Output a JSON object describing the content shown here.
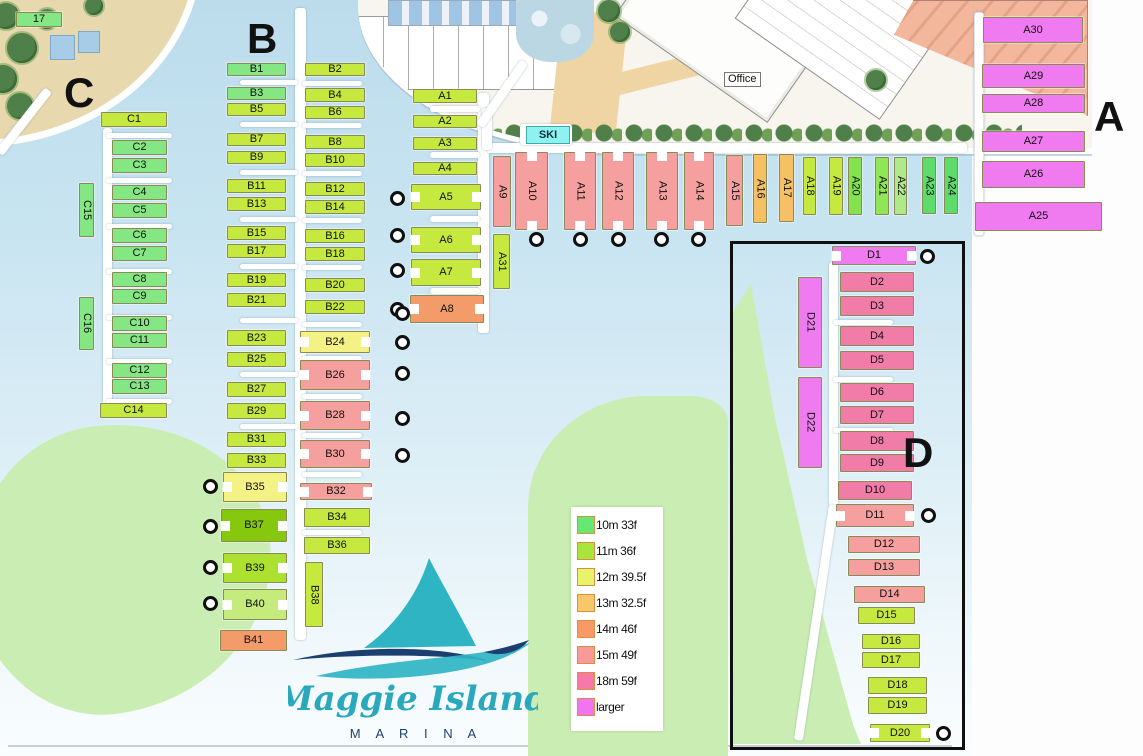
{
  "branding": {
    "script": "Maggie Island",
    "sub": "M A R I N A"
  },
  "labels": {
    "office": "Office",
    "ski": "SKI"
  },
  "legend": {
    "items": [
      {
        "label": "10m 33f",
        "color": "#66E873"
      },
      {
        "label": "11m 36f",
        "color": "#A9E63C"
      },
      {
        "label": "12m 39.5f",
        "color": "#E9F26B"
      },
      {
        "label": "13m 32.5f",
        "color": "#F8C76A"
      },
      {
        "label": "14m 46f",
        "color": "#F79A67"
      },
      {
        "label": "15m 49f",
        "color": "#F79A98"
      },
      {
        "label": "18m 59f",
        "color": "#F779A7"
      },
      {
        "label": "larger",
        "color": "#F175F0"
      }
    ]
  },
  "colors": {
    "g10": "#84E783",
    "g10b": "#5DDC6C",
    "y11": "#C6E93F",
    "y12": "#F5F285",
    "o13": "#F6C065",
    "o14": "#F49B6A",
    "p15": "#F5A09E",
    "p18": "#F27CA8",
    "mag": "#F07AEF",
    "b37": "#85C80D",
    "b39": "#ACE22F",
    "b40": "#C6EB7D",
    "a20": "#84E24F",
    "a21": "#8FE657",
    "a22": "#AEE98C"
  },
  "sections": [
    {
      "id": "A",
      "label": "A",
      "x": 1094,
      "y": 96
    },
    {
      "id": "B",
      "label": "B",
      "x": 247,
      "y": 18
    },
    {
      "id": "C",
      "label": "C",
      "x": 64,
      "y": 72
    },
    {
      "id": "D",
      "label": "D",
      "x": 903,
      "y": 432
    }
  ],
  "berths": [
    {
      "id": "17",
      "x": 16,
      "y": 12,
      "w": 46,
      "h": 15,
      "c": "g10"
    },
    {
      "id": "C1",
      "x": 101,
      "y": 112,
      "w": 66,
      "h": 15,
      "c": "y11"
    },
    {
      "id": "C2",
      "x": 112,
      "y": 140,
      "w": 55,
      "h": 15,
      "c": "g10"
    },
    {
      "id": "C3",
      "x": 112,
      "y": 158,
      "w": 55,
      "h": 15,
      "c": "g10"
    },
    {
      "id": "C4",
      "x": 112,
      "y": 185,
      "w": 55,
      "h": 15,
      "c": "g10"
    },
    {
      "id": "C5",
      "x": 112,
      "y": 203,
      "w": 55,
      "h": 15,
      "c": "g10"
    },
    {
      "id": "C6",
      "x": 112,
      "y": 228,
      "w": 55,
      "h": 15,
      "c": "g10"
    },
    {
      "id": "C7",
      "x": 112,
      "y": 246,
      "w": 55,
      "h": 15,
      "c": "g10"
    },
    {
      "id": "C8",
      "x": 112,
      "y": 272,
      "w": 55,
      "h": 15,
      "c": "g10"
    },
    {
      "id": "C9",
      "x": 112,
      "y": 289,
      "w": 55,
      "h": 15,
      "c": "g10"
    },
    {
      "id": "C10",
      "x": 112,
      "y": 316,
      "w": 55,
      "h": 15,
      "c": "g10"
    },
    {
      "id": "C11",
      "x": 112,
      "y": 333,
      "w": 55,
      "h": 15,
      "c": "g10"
    },
    {
      "id": "C12",
      "x": 112,
      "y": 363,
      "w": 55,
      "h": 15,
      "c": "g10"
    },
    {
      "id": "C13",
      "x": 112,
      "y": 379,
      "w": 55,
      "h": 15,
      "c": "g10"
    },
    {
      "id": "C14",
      "x": 100,
      "y": 403,
      "w": 67,
      "h": 15,
      "c": "y11"
    },
    {
      "id": "C15",
      "x": 79,
      "y": 183,
      "w": 15,
      "h": 54,
      "c": "g10",
      "v": 1
    },
    {
      "id": "C16",
      "x": 79,
      "y": 297,
      "w": 15,
      "h": 53,
      "c": "g10",
      "v": 1
    },
    {
      "id": "B1",
      "x": 227,
      "y": 63,
      "w": 59,
      "h": 13,
      "c": "g10"
    },
    {
      "id": "B3",
      "x": 227,
      "y": 87,
      "w": 59,
      "h": 13,
      "c": "g10"
    },
    {
      "id": "B5",
      "x": 227,
      "y": 103,
      "w": 59,
      "h": 13,
      "c": "y11"
    },
    {
      "id": "B7",
      "x": 227,
      "y": 133,
      "w": 59,
      "h": 13,
      "c": "y11"
    },
    {
      "id": "B9",
      "x": 227,
      "y": 151,
      "w": 59,
      "h": 13,
      "c": "y11"
    },
    {
      "id": "B11",
      "x": 227,
      "y": 179,
      "w": 59,
      "h": 14,
      "c": "y11"
    },
    {
      "id": "B13",
      "x": 227,
      "y": 197,
      "w": 59,
      "h": 14,
      "c": "y11"
    },
    {
      "id": "B15",
      "x": 227,
      "y": 226,
      "w": 59,
      "h": 14,
      "c": "y11"
    },
    {
      "id": "B17",
      "x": 227,
      "y": 244,
      "w": 59,
      "h": 14,
      "c": "y11"
    },
    {
      "id": "B19",
      "x": 227,
      "y": 273,
      "w": 59,
      "h": 14,
      "c": "y11"
    },
    {
      "id": "B21",
      "x": 227,
      "y": 293,
      "w": 59,
      "h": 14,
      "c": "y11"
    },
    {
      "id": "B23",
      "x": 227,
      "y": 330,
      "w": 59,
      "h": 16,
      "c": "y11"
    },
    {
      "id": "B25",
      "x": 227,
      "y": 352,
      "w": 59,
      "h": 15,
      "c": "y11"
    },
    {
      "id": "B27",
      "x": 227,
      "y": 382,
      "w": 59,
      "h": 15,
      "c": "y11"
    },
    {
      "id": "B29",
      "x": 227,
      "y": 403,
      "w": 59,
      "h": 16,
      "c": "y11"
    },
    {
      "id": "B31",
      "x": 227,
      "y": 432,
      "w": 59,
      "h": 15,
      "c": "y11"
    },
    {
      "id": "B33",
      "x": 227,
      "y": 453,
      "w": 59,
      "h": 15,
      "c": "y11"
    },
    {
      "id": "B35",
      "x": 223,
      "y": 472,
      "w": 64,
      "h": 30,
      "c": "y12",
      "n": 1
    },
    {
      "id": "B37",
      "x": 221,
      "y": 509,
      "w": 66,
      "h": 33,
      "c": "b37",
      "n": 1
    },
    {
      "id": "B39",
      "x": 223,
      "y": 553,
      "w": 64,
      "h": 30,
      "c": "b39",
      "n": 1
    },
    {
      "id": "B40",
      "x": 223,
      "y": 589,
      "w": 64,
      "h": 31,
      "c": "b40",
      "n": 1
    },
    {
      "id": "B41",
      "x": 220,
      "y": 630,
      "w": 67,
      "h": 21,
      "c": "o14"
    },
    {
      "id": "B2",
      "x": 305,
      "y": 63,
      "w": 60,
      "h": 13,
      "c": "y11"
    },
    {
      "id": "B4",
      "x": 305,
      "y": 88,
      "w": 60,
      "h": 14,
      "c": "y11"
    },
    {
      "id": "B6",
      "x": 305,
      "y": 106,
      "w": 60,
      "h": 13,
      "c": "y11"
    },
    {
      "id": "B8",
      "x": 305,
      "y": 135,
      "w": 60,
      "h": 14,
      "c": "y11"
    },
    {
      "id": "B10",
      "x": 305,
      "y": 153,
      "w": 60,
      "h": 14,
      "c": "y11"
    },
    {
      "id": "B12",
      "x": 305,
      "y": 182,
      "w": 60,
      "h": 14,
      "c": "y11"
    },
    {
      "id": "B14",
      "x": 305,
      "y": 200,
      "w": 60,
      "h": 14,
      "c": "y11"
    },
    {
      "id": "B16",
      "x": 305,
      "y": 229,
      "w": 60,
      "h": 14,
      "c": "y11"
    },
    {
      "id": "B18",
      "x": 305,
      "y": 247,
      "w": 60,
      "h": 14,
      "c": "y11"
    },
    {
      "id": "B20",
      "x": 305,
      "y": 278,
      "w": 60,
      "h": 14,
      "c": "y11"
    },
    {
      "id": "B22",
      "x": 305,
      "y": 300,
      "w": 60,
      "h": 14,
      "c": "y11"
    },
    {
      "id": "B24",
      "x": 300,
      "y": 331,
      "w": 70,
      "h": 22,
      "c": "y12",
      "n": 1
    },
    {
      "id": "B26",
      "x": 300,
      "y": 360,
      "w": 70,
      "h": 30,
      "c": "p15",
      "n": 1
    },
    {
      "id": "B28",
      "x": 300,
      "y": 401,
      "w": 70,
      "h": 29,
      "c": "p15",
      "n": 1
    },
    {
      "id": "B30",
      "x": 300,
      "y": 440,
      "w": 70,
      "h": 28,
      "c": "p15",
      "n": 1
    },
    {
      "id": "B32",
      "x": 300,
      "y": 483,
      "w": 72,
      "h": 17,
      "c": "p15",
      "n": 1
    },
    {
      "id": "B34",
      "x": 304,
      "y": 508,
      "w": 66,
      "h": 19,
      "c": "y11"
    },
    {
      "id": "B36",
      "x": 304,
      "y": 537,
      "w": 66,
      "h": 17,
      "c": "y11"
    },
    {
      "id": "B38",
      "x": 305,
      "y": 562,
      "w": 18,
      "h": 65,
      "c": "y11",
      "v": 1
    },
    {
      "id": "A1",
      "x": 413,
      "y": 89,
      "w": 64,
      "h": 14,
      "c": "y11"
    },
    {
      "id": "A2",
      "x": 413,
      "y": 115,
      "w": 64,
      "h": 13,
      "c": "y11"
    },
    {
      "id": "A3",
      "x": 413,
      "y": 137,
      "w": 64,
      "h": 13,
      "c": "y11"
    },
    {
      "id": "A4",
      "x": 413,
      "y": 162,
      "w": 64,
      "h": 13,
      "c": "y11"
    },
    {
      "id": "A5",
      "x": 411,
      "y": 184,
      "w": 70,
      "h": 26,
      "c": "y11",
      "n": 1
    },
    {
      "id": "A6",
      "x": 411,
      "y": 227,
      "w": 70,
      "h": 26,
      "c": "y11",
      "n": 1
    },
    {
      "id": "A7",
      "x": 411,
      "y": 259,
      "w": 70,
      "h": 27,
      "c": "y11",
      "n": 1
    },
    {
      "id": "A8",
      "x": 410,
      "y": 295,
      "w": 74,
      "h": 28,
      "c": "o14",
      "n": 1
    },
    {
      "id": "A31",
      "x": 493,
      "y": 234,
      "w": 17,
      "h": 55,
      "c": "y11",
      "v": 1
    },
    {
      "id": "A9",
      "x": 493,
      "y": 156,
      "w": 18,
      "h": 71,
      "c": "p15",
      "v": 1
    },
    {
      "id": "A10",
      "x": 515,
      "y": 152,
      "w": 33,
      "h": 78,
      "c": "p15",
      "v": 1,
      "n": 1
    },
    {
      "id": "A11",
      "x": 564,
      "y": 152,
      "w": 32,
      "h": 78,
      "c": "p15",
      "v": 1,
      "n": 1
    },
    {
      "id": "A12",
      "x": 602,
      "y": 152,
      "w": 32,
      "h": 78,
      "c": "p15",
      "v": 1,
      "n": 1
    },
    {
      "id": "A13",
      "x": 646,
      "y": 152,
      "w": 32,
      "h": 78,
      "c": "p15",
      "v": 1,
      "n": 1
    },
    {
      "id": "A14",
      "x": 684,
      "y": 152,
      "w": 30,
      "h": 78,
      "c": "p15",
      "v": 1,
      "n": 1
    },
    {
      "id": "A15",
      "x": 726,
      "y": 155,
      "w": 17,
      "h": 71,
      "c": "p15",
      "v": 1
    },
    {
      "id": "A16",
      "x": 753,
      "y": 154,
      "w": 14,
      "h": 69,
      "c": "o13",
      "v": 1
    },
    {
      "id": "A17",
      "x": 779,
      "y": 154,
      "w": 15,
      "h": 68,
      "c": "o13",
      "v": 1
    },
    {
      "id": "A18",
      "x": 803,
      "y": 157,
      "w": 13,
      "h": 58,
      "c": "y11",
      "v": 1
    },
    {
      "id": "A19",
      "x": 829,
      "y": 157,
      "w": 14,
      "h": 58,
      "c": "y11",
      "v": 1
    },
    {
      "id": "A20",
      "x": 848,
      "y": 157,
      "w": 14,
      "h": 58,
      "c": "a20",
      "v": 1
    },
    {
      "id": "A21",
      "x": 875,
      "y": 157,
      "w": 14,
      "h": 58,
      "c": "a21",
      "v": 1
    },
    {
      "id": "A22",
      "x": 894,
      "y": 157,
      "w": 13,
      "h": 58,
      "c": "a22",
      "v": 1
    },
    {
      "id": "A23",
      "x": 922,
      "y": 157,
      "w": 14,
      "h": 57,
      "c": "g10b",
      "v": 1
    },
    {
      "id": "A24",
      "x": 944,
      "y": 157,
      "w": 14,
      "h": 57,
      "c": "g10b",
      "v": 1
    },
    {
      "id": "A30",
      "x": 983,
      "y": 17,
      "w": 100,
      "h": 26,
      "c": "mag"
    },
    {
      "id": "A29",
      "x": 982,
      "y": 64,
      "w": 103,
      "h": 24,
      "c": "mag"
    },
    {
      "id": "A28",
      "x": 982,
      "y": 94,
      "w": 103,
      "h": 19,
      "c": "mag"
    },
    {
      "id": "A27",
      "x": 982,
      "y": 131,
      "w": 103,
      "h": 21,
      "c": "mag"
    },
    {
      "id": "A26",
      "x": 982,
      "y": 161,
      "w": 103,
      "h": 27,
      "c": "mag"
    },
    {
      "id": "A25",
      "x": 975,
      "y": 202,
      "w": 127,
      "h": 29,
      "c": "mag"
    },
    {
      "id": "D1",
      "x": 832,
      "y": 246,
      "w": 84,
      "h": 19,
      "c": "mag",
      "n": 1
    },
    {
      "id": "D2",
      "x": 840,
      "y": 272,
      "w": 74,
      "h": 20,
      "c": "p18"
    },
    {
      "id": "D3",
      "x": 840,
      "y": 296,
      "w": 74,
      "h": 20,
      "c": "p18"
    },
    {
      "id": "D4",
      "x": 840,
      "y": 326,
      "w": 74,
      "h": 20,
      "c": "p18"
    },
    {
      "id": "D5",
      "x": 840,
      "y": 351,
      "w": 74,
      "h": 19,
      "c": "p18"
    },
    {
      "id": "D6",
      "x": 840,
      "y": 383,
      "w": 74,
      "h": 19,
      "c": "p18"
    },
    {
      "id": "D7",
      "x": 840,
      "y": 406,
      "w": 74,
      "h": 18,
      "c": "p18"
    },
    {
      "id": "D8",
      "x": 840,
      "y": 431,
      "w": 74,
      "h": 20,
      "c": "p18"
    },
    {
      "id": "D9",
      "x": 840,
      "y": 454,
      "w": 74,
      "h": 18,
      "c": "p18"
    },
    {
      "id": "D10",
      "x": 838,
      "y": 481,
      "w": 74,
      "h": 19,
      "c": "p18"
    },
    {
      "id": "D11",
      "x": 836,
      "y": 504,
      "w": 78,
      "h": 23,
      "c": "p15",
      "n": 1
    },
    {
      "id": "D12",
      "x": 848,
      "y": 536,
      "w": 72,
      "h": 17,
      "c": "p15"
    },
    {
      "id": "D13",
      "x": 848,
      "y": 559,
      "w": 72,
      "h": 17,
      "c": "p15"
    },
    {
      "id": "D14",
      "x": 854,
      "y": 586,
      "w": 71,
      "h": 17,
      "c": "p15"
    },
    {
      "id": "D15",
      "x": 858,
      "y": 607,
      "w": 57,
      "h": 17,
      "c": "y11"
    },
    {
      "id": "D16",
      "x": 862,
      "y": 634,
      "w": 58,
      "h": 15,
      "c": "y11"
    },
    {
      "id": "D17",
      "x": 862,
      "y": 652,
      "w": 58,
      "h": 16,
      "c": "y11"
    },
    {
      "id": "D18",
      "x": 868,
      "y": 677,
      "w": 59,
      "h": 17,
      "c": "y11"
    },
    {
      "id": "D19",
      "x": 868,
      "y": 697,
      "w": 59,
      "h": 17,
      "c": "y11"
    },
    {
      "id": "D20",
      "x": 870,
      "y": 724,
      "w": 60,
      "h": 18,
      "c": "y11",
      "n": 1
    },
    {
      "id": "D21",
      "x": 798,
      "y": 277,
      "w": 24,
      "h": 91,
      "c": "mag",
      "v": 1
    },
    {
      "id": "D22",
      "x": 798,
      "y": 377,
      "w": 24,
      "h": 91,
      "c": "mag",
      "v": 1
    }
  ],
  "circles": [
    {
      "x": 398,
      "y": 199
    },
    {
      "x": 398,
      "y": 236
    },
    {
      "x": 398,
      "y": 271
    },
    {
      "x": 398,
      "y": 310
    },
    {
      "x": 537,
      "y": 240
    },
    {
      "x": 581,
      "y": 240
    },
    {
      "x": 619,
      "y": 240
    },
    {
      "x": 662,
      "y": 240
    },
    {
      "x": 699,
      "y": 240
    },
    {
      "x": 403,
      "y": 314
    },
    {
      "x": 403,
      "y": 343
    },
    {
      "x": 403,
      "y": 374
    },
    {
      "x": 403,
      "y": 419
    },
    {
      "x": 403,
      "y": 456
    },
    {
      "x": 211,
      "y": 487
    },
    {
      "x": 211,
      "y": 527
    },
    {
      "x": 211,
      "y": 568
    },
    {
      "x": 211,
      "y": 604
    },
    {
      "x": 928,
      "y": 257
    },
    {
      "x": 929,
      "y": 516
    },
    {
      "x": 944,
      "y": 734
    }
  ]
}
